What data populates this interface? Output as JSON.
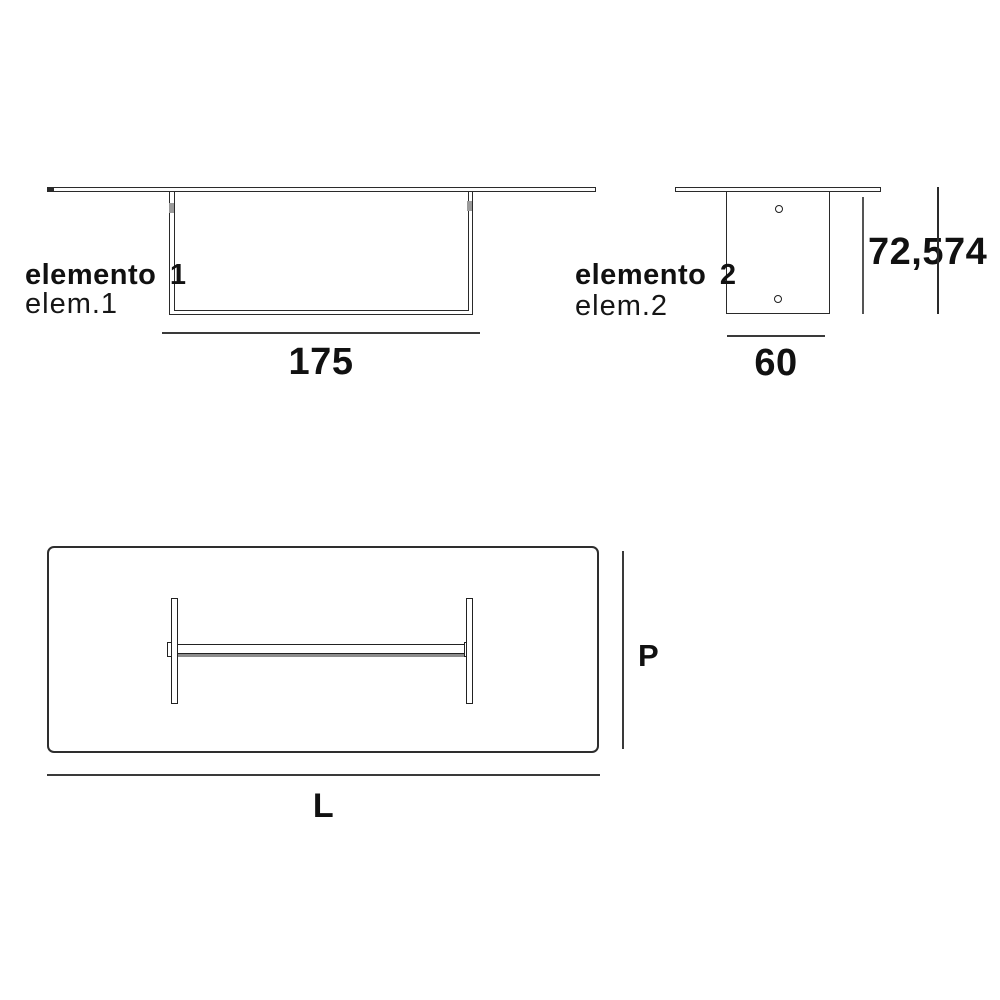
{
  "diagram": {
    "title": "table dimension drawing",
    "ink_color": "#1c1c1c",
    "side_view": {
      "label_bold": "elemento 1",
      "label_small": "elem.1",
      "width_value": "175"
    },
    "end_view": {
      "label_bold": "elemento 2",
      "label_small": "elem.2",
      "width_value": "60",
      "leg_height_value": "72,5",
      "total_height_value": "74"
    },
    "top_view": {
      "depth_label": "P",
      "length_label": "L"
    }
  }
}
